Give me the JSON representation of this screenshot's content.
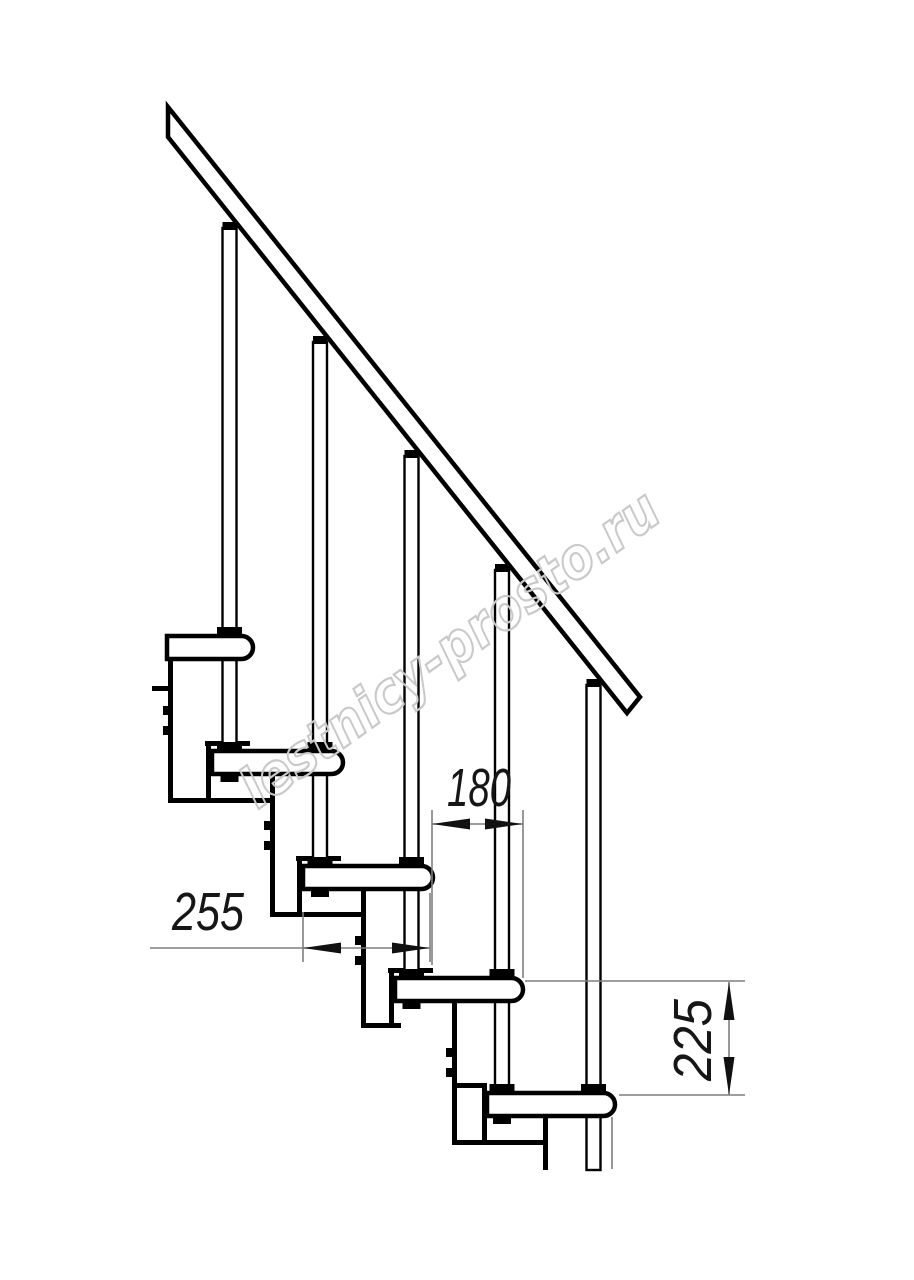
{
  "title": "staircase-side-view-drawing",
  "colors": {
    "background": "#ffffff",
    "ink": "#000000",
    "thin_line": "#7f7f7f",
    "watermark": "#c9c9c9"
  },
  "watermark": {
    "text": "lestnicy-prosto.ru",
    "x": 452,
    "y": 652,
    "angle": -35.6,
    "length": 500
  },
  "dimensions": {
    "run_180": {
      "label": "180",
      "text_x": 479,
      "text_y": 806,
      "text_length": 64,
      "line_y": 824,
      "x1": 432,
      "x2": 523,
      "ext_lines": [
        [
          432,
          810,
          965
        ],
        [
          523,
          810,
          978
        ]
      ]
    },
    "run_255": {
      "label": "255",
      "text_x": 208,
      "text_y": 930,
      "text_length": 72,
      "line_y": 948,
      "x1": 303,
      "x2": 430,
      "tail_x": 150,
      "ext_lines": [
        [
          303,
          912,
          962
        ],
        [
          430,
          893,
          962
        ]
      ]
    },
    "rise_225": {
      "label": "225",
      "text_x": 711,
      "text_y": 1040,
      "text_length": 82,
      "line_x": 729,
      "y1": 982,
      "y2": 1095,
      "ext_lines_h": [
        [
          981,
          525,
          745
        ],
        [
          1095,
          619,
          745
        ]
      ]
    }
  },
  "geometry": {
    "rail": {
      "points": [
        [
          168,
          107
        ],
        [
          640,
          697
        ],
        [
          627,
          713
        ],
        [
          168,
          137
        ]
      ],
      "stroke_w": 4.5
    },
    "tread_h": 23,
    "tread_r": 11.5,
    "tread_stroke": 4.5,
    "treads": [
      {
        "x": 167,
        "y": 636,
        "w": 86
      },
      {
        "x": 212,
        "y": 751,
        "w": 131
      },
      {
        "x": 303,
        "y": 866,
        "w": 130
      },
      {
        "x": 395,
        "y": 978,
        "w": 128
      },
      {
        "x": 487,
        "y": 1093,
        "w": 128
      }
    ],
    "pipes": [
      {
        "cx": 229.5,
        "cap_y": 222,
        "top": 228,
        "bottom": 776,
        "collars": [
          627,
          742
        ],
        "nut_y": 774
      },
      {
        "cx": 320,
        "cap_y": 336,
        "top": 342,
        "bottom": 891,
        "collars": [
          742,
          857
        ],
        "nut_y": 889
      },
      {
        "cx": 411.5,
        "cap_y": 450,
        "top": 456,
        "bottom": 1003,
        "collars": [
          857,
          969
        ],
        "nut_y": 1001
      },
      {
        "cx": 502,
        "cap_y": 564,
        "top": 570,
        "bottom": 1118,
        "collars": [
          969,
          1084
        ],
        "nut_y": 1116
      },
      {
        "cx": 593.5,
        "cap_y": 679,
        "top": 685,
        "bottom": 1170,
        "collars": [
          1084
        ],
        "nut_y": null
      }
    ],
    "pipe_w": 14,
    "pipe_stroke": 2.4,
    "collar_w": 25,
    "collar_h": 9,
    "nut_w": 18,
    "nut_h": 8,
    "cap_w": 14,
    "cap_h": 8,
    "columns": [
      [
        168,
        656,
        147
      ],
      [
        270,
        774,
        143
      ],
      [
        361,
        889,
        139
      ],
      [
        452,
        1001,
        144
      ],
      [
        543,
        1116,
        54
      ]
    ],
    "column_w": 5,
    "hbars": [
      [
        152,
        686,
        21
      ],
      [
        168,
        798,
        107
      ],
      [
        270,
        912,
        96
      ],
      [
        361,
        1023,
        40
      ],
      [
        452,
        1140,
        96
      ]
    ],
    "hbar_h": 5,
    "nubs": [
      [
        163,
        706
      ],
      [
        163,
        726
      ],
      [
        264,
        821
      ],
      [
        264,
        841
      ],
      [
        355,
        936
      ],
      [
        355,
        956
      ],
      [
        446,
        1048
      ],
      [
        446,
        1068
      ]
    ],
    "nub_w": 6,
    "nub_h": 9,
    "plates": {
      "bars": [
        [
          205,
          741,
          45
        ],
        [
          296,
          856,
          45
        ],
        [
          388,
          968,
          45
        ],
        [
          452,
          1083,
          35
        ]
      ],
      "bar_h": 5,
      "verts": [
        [
          206,
          746,
          52
        ],
        [
          297,
          861,
          51
        ],
        [
          389,
          973,
          50
        ],
        [
          482,
          1088,
          52
        ]
      ],
      "vert_w": 5
    },
    "thin_cut_line": [
      612,
      1117,
      52
    ],
    "arrow_len": 38,
    "arrow_half_w": 5.5
  }
}
